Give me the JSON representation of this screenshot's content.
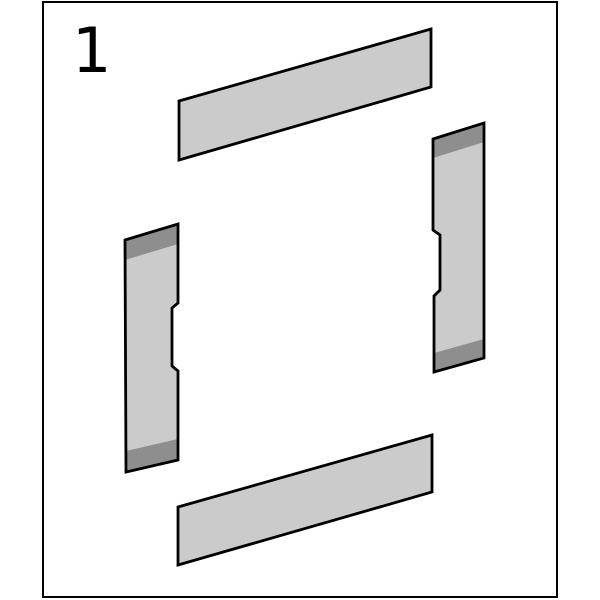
{
  "step": {
    "number": "1"
  },
  "colors": {
    "background": "#ffffff",
    "frame_border": "#000000",
    "panel_face": "#cbcbcb",
    "panel_edge_dark": "#8e8e8e",
    "outline": "#000000"
  },
  "frame": {
    "points": "43,2 557,2 557,597 43,597"
  },
  "panels": {
    "top": {
      "points": "179,101 431,29 431,87 179,160"
    },
    "bottom": {
      "points": "178,507 432,435 432,492 178,565"
    },
    "left": {
      "outline": "125,240 178,224 178,303 172,308 172,366 178,371 178,460 126,472",
      "top_edge": "125,240 178,224 178,244 125,260",
      "bottom_edge": "126,451 178,439 178,460 126,472"
    },
    "right": {
      "outline": "433,139 484,123 484,358 434,372 434,296 440,290 440,235 433,230",
      "top_edge": "433,139 484,123 484,142 433,158",
      "bottom_edge": "434,353 484,339 484,358 434,372"
    }
  }
}
